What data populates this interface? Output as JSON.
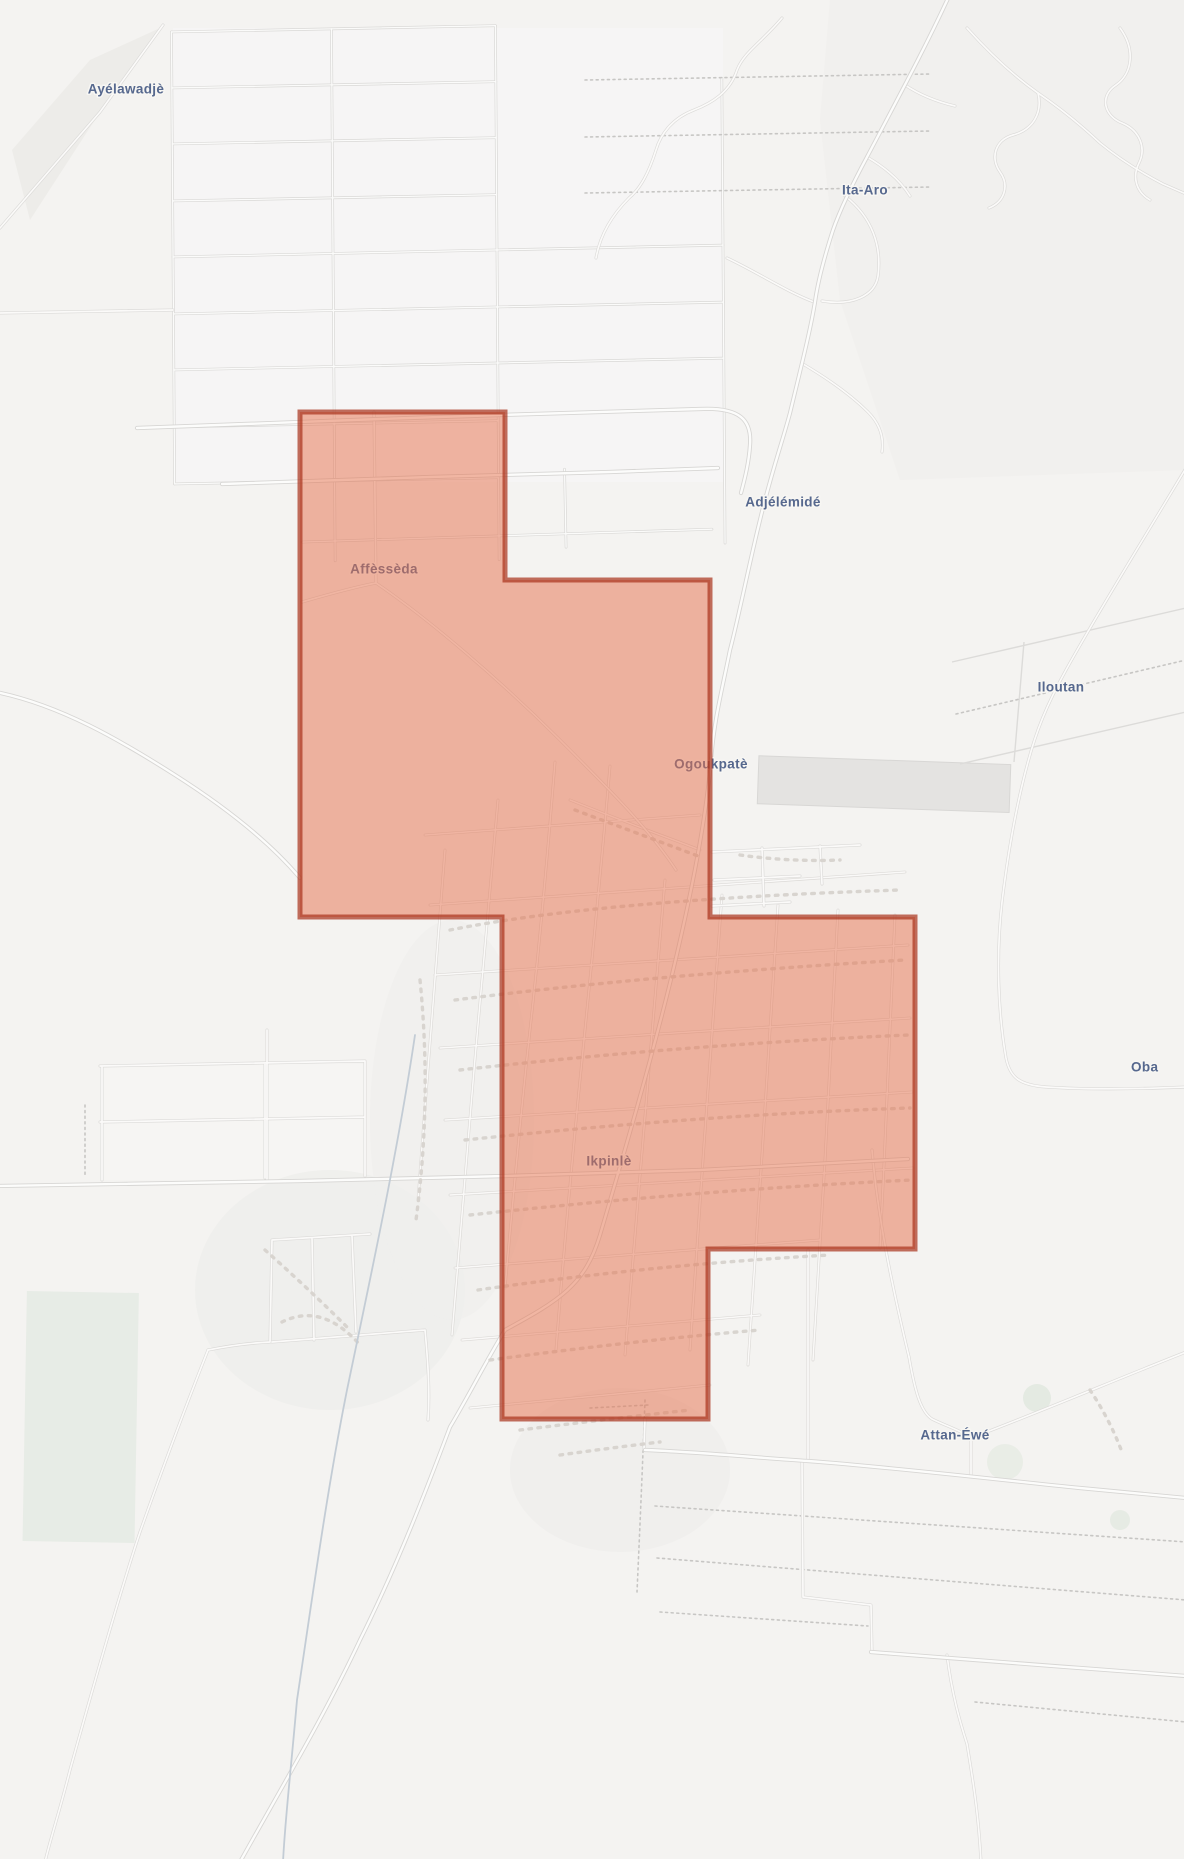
{
  "map": {
    "background_color": "#f4f3f1",
    "label_color": "#56688e",
    "label_halo_color": "#f7f6f3",
    "label_font_size": 13.5,
    "place_labels": [
      {
        "name": "Ayélawadjè",
        "x": 126,
        "y": 89,
        "anchor": "middle"
      },
      {
        "name": "Ita-Aro",
        "x": 865,
        "y": 190,
        "anchor": "middle"
      },
      {
        "name": "Adjélémidé",
        "x": 783,
        "y": 502,
        "anchor": "middle"
      },
      {
        "name": "Affèssèda",
        "x": 384,
        "y": 569,
        "anchor": "middle"
      },
      {
        "name": "Iloutan",
        "x": 1061,
        "y": 687,
        "anchor": "middle"
      },
      {
        "name": "Ogoukpatè",
        "x": 711,
        "y": 764,
        "anchor": "middle"
      },
      {
        "name": "Oba",
        "x": 1131,
        "y": 1067,
        "anchor": "start"
      },
      {
        "name": "Ikpinlè",
        "x": 609,
        "y": 1161,
        "anchor": "middle"
      },
      {
        "name": "Attan-Éwé",
        "x": 955,
        "y": 1435,
        "anchor": "middle"
      }
    ],
    "highlighted_region": {
      "fill": "rgba(229,111,75,0.5)",
      "stroke": "rgba(168,48,25,0.7)",
      "stroke_width": 5,
      "points": [
        [
          300,
          412
        ],
        [
          505,
          412
        ],
        [
          505,
          580
        ],
        [
          710,
          580
        ],
        [
          710,
          917
        ],
        [
          915,
          917
        ],
        [
          915,
          1249
        ],
        [
          708,
          1249
        ],
        [
          708,
          1419
        ],
        [
          502,
          1419
        ],
        [
          502,
          917
        ],
        [
          300,
          917
        ]
      ]
    }
  }
}
